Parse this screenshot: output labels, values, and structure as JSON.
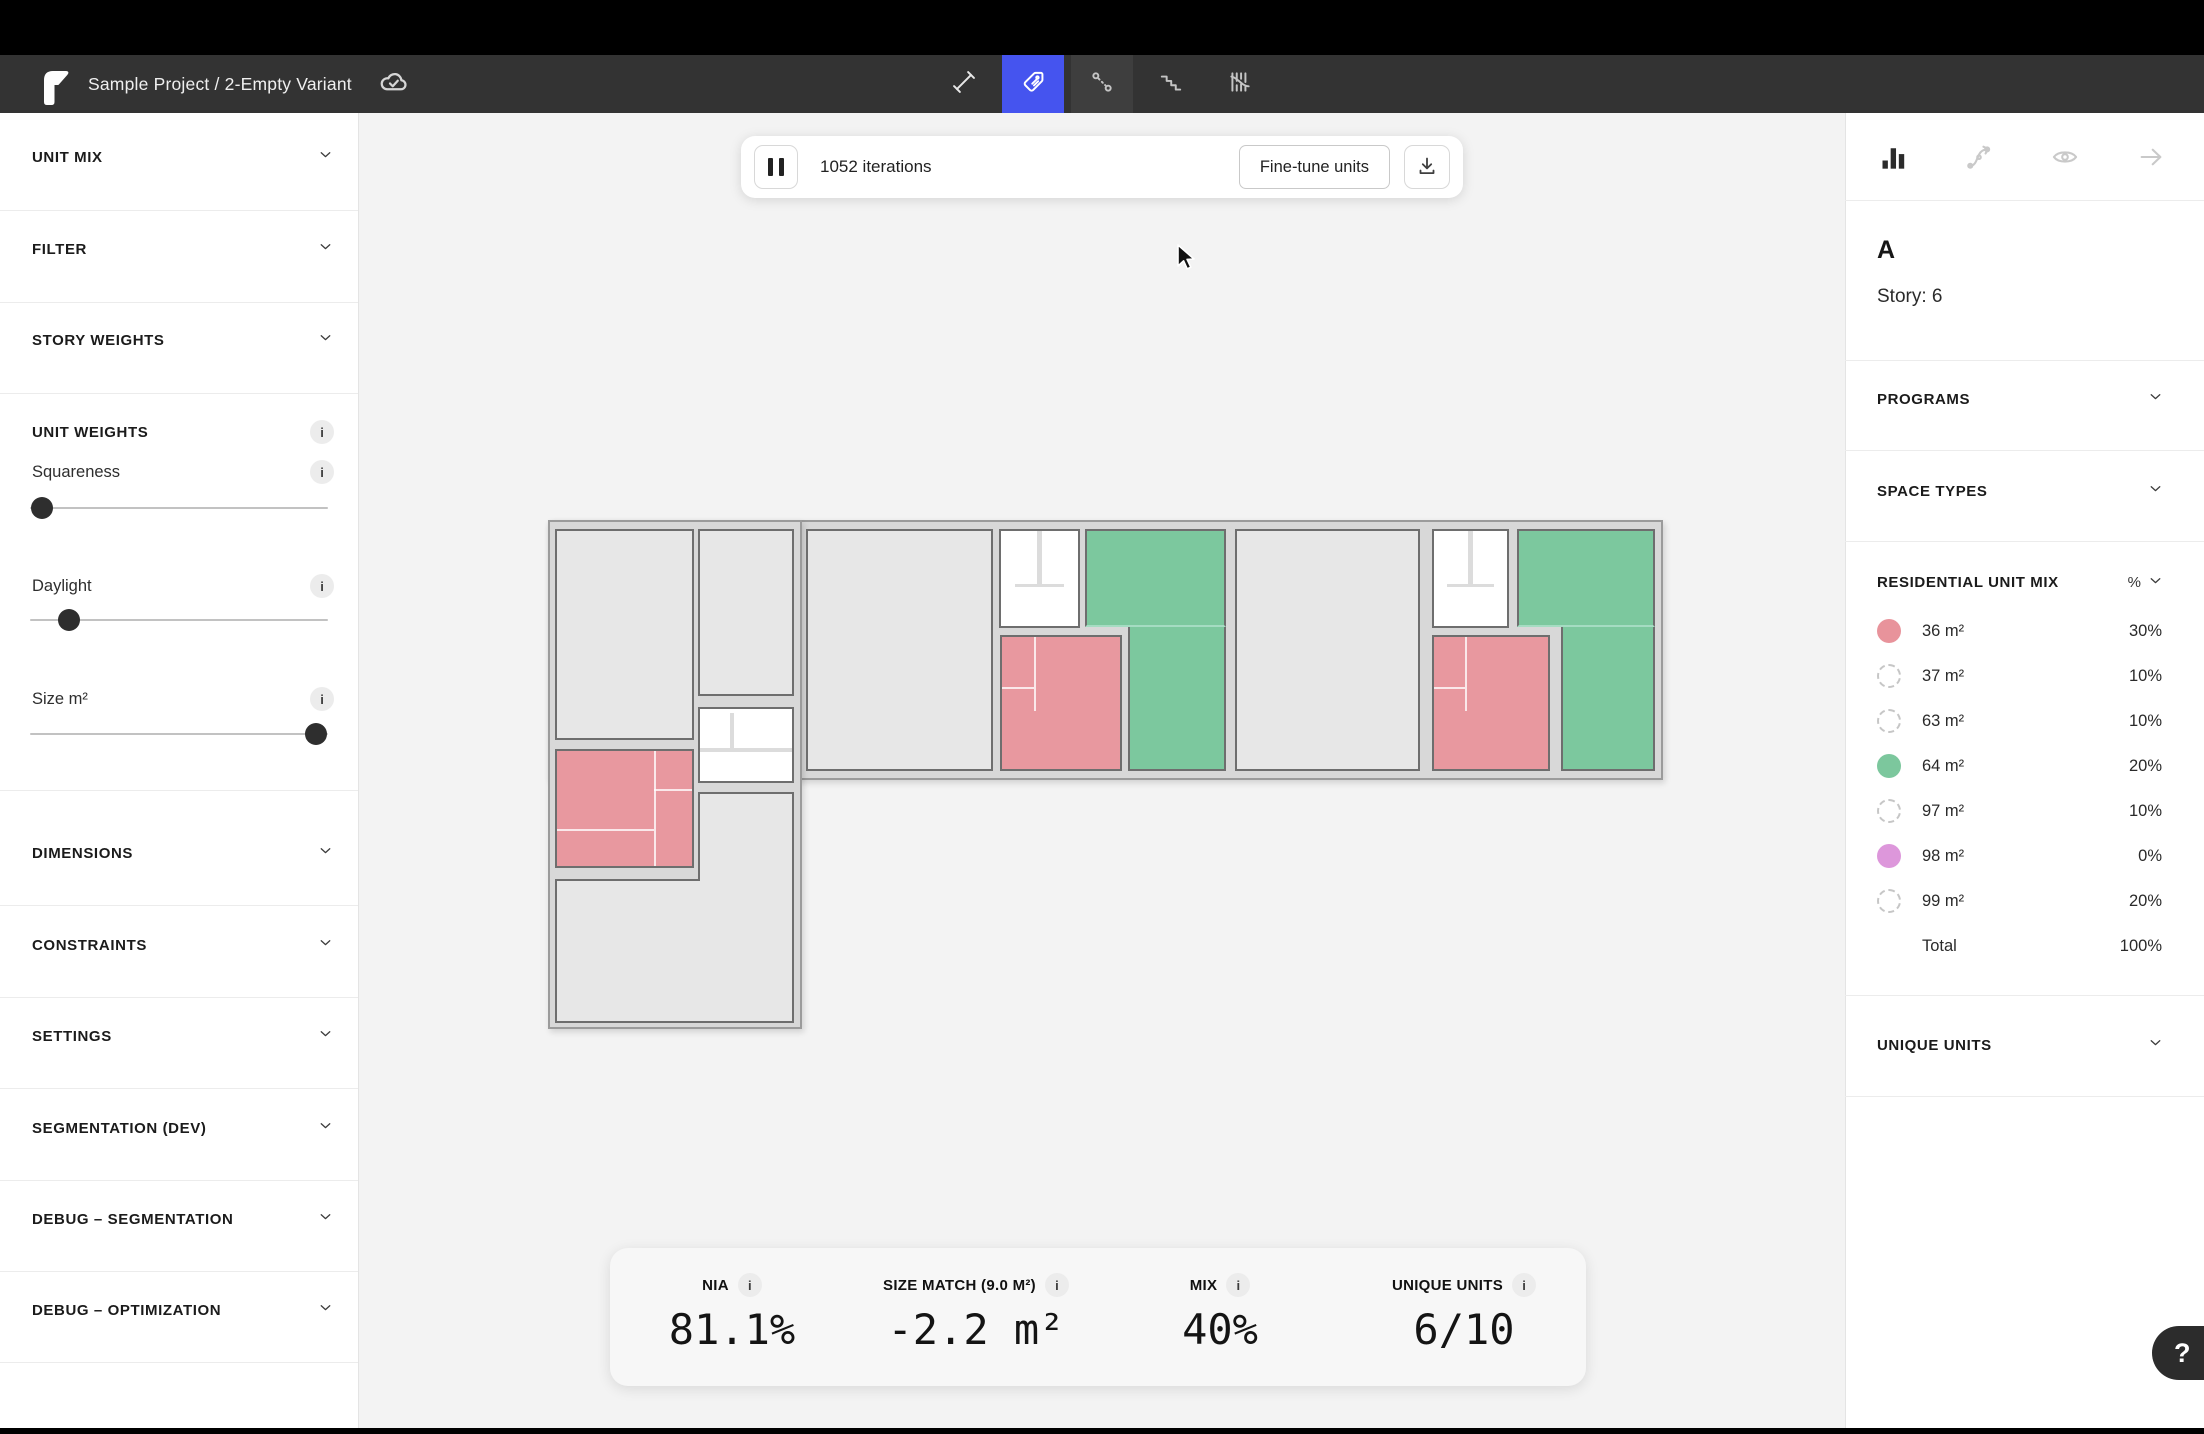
{
  "titlebar": {
    "title": "Sample Project / 2-Empty Variant",
    "logo_icon": "finch-logo",
    "sync_icon": "cloud-check",
    "active_color": "#4554ef",
    "tools": [
      {
        "name": "measure-tool",
        "icon": "measure",
        "active": false,
        "highlight": false
      },
      {
        "name": "tag-tool",
        "icon": "tag",
        "active": true,
        "highlight": false
      },
      {
        "name": "adjacency-tool",
        "icon": "adjacency",
        "active": false,
        "highlight": true
      },
      {
        "name": "stairs-tool",
        "icon": "stairs",
        "active": false,
        "highlight": false
      },
      {
        "name": "hatch-tool",
        "icon": "hatch",
        "active": false,
        "highlight": false
      }
    ]
  },
  "sidebar": {
    "sections_top": [
      {
        "label": "UNIT MIX",
        "y": 157,
        "divider_y": 210
      },
      {
        "label": "FILTER",
        "y": 249,
        "divider_y": 302
      },
      {
        "label": "STORY WEIGHTS",
        "y": 340,
        "divider_y": 393
      }
    ],
    "unit_weights": {
      "label": "UNIT WEIGHTS",
      "y": 432,
      "divider_y": 790,
      "sliders": [
        {
          "label": "Squareness",
          "label_y": 472,
          "slider_y": 508,
          "value_pct": 4
        },
        {
          "label": "Daylight",
          "label_y": 586,
          "slider_y": 620,
          "value_pct": 13
        },
        {
          "label": "Size m²",
          "label_y": 699,
          "slider_y": 734,
          "value_pct": 96
        }
      ]
    },
    "sections_bottom": [
      {
        "label": "DIMENSIONS",
        "y": 853,
        "divider_y": 905
      },
      {
        "label": "CONSTRAINTS",
        "y": 945,
        "divider_y": 997
      },
      {
        "label": "SETTINGS",
        "y": 1036,
        "divider_y": 1088
      },
      {
        "label": "SEGMENTATION (DEV)",
        "y": 1128,
        "divider_y": 1180
      },
      {
        "label": "DEBUG – SEGMENTATION",
        "y": 1219,
        "divider_y": 1271
      },
      {
        "label": "DEBUG – OPTIMIZATION",
        "y": 1310,
        "divider_y": 1362
      }
    ]
  },
  "canvas": {
    "iterations": "1052 iterations",
    "fine_tune_label": "Fine-tune units",
    "stats": [
      {
        "label": "NIA",
        "value": "81.1%"
      },
      {
        "label": "SIZE MATCH (9.0 M²)",
        "value": "-2.2 m²"
      },
      {
        "label": "MIX",
        "value": "40%"
      },
      {
        "label": "UNIQUE UNITS",
        "value": "6/10"
      }
    ]
  },
  "panel": {
    "icons": [
      {
        "name": "chart-icon",
        "active": true
      },
      {
        "name": "flow-icon",
        "active": false
      },
      {
        "name": "eye-icon",
        "active": false
      },
      {
        "name": "arrow-right-icon",
        "active": false
      }
    ],
    "variant": "A",
    "story": "Story: 6",
    "sections": [
      {
        "label": "PROGRAMS",
        "y": 399
      },
      {
        "label": "SPACE TYPES",
        "y": 491
      }
    ],
    "dividers": [
      200,
      360,
      450,
      541,
      995,
      1096
    ],
    "unit_mix": {
      "title": "RESIDENTIAL UNIT MIX",
      "title_y": 582,
      "unit_header": "%",
      "rows_start_y": 631,
      "rows_step": 45,
      "rows": [
        {
          "size": "36 m²",
          "pct": "30%",
          "swatch": "#e8939b"
        },
        {
          "size": "37 m²",
          "pct": "10%",
          "swatch": null
        },
        {
          "size": "63 m²",
          "pct": "10%",
          "swatch": null
        },
        {
          "size": "64 m²",
          "pct": "20%",
          "swatch": "#7cc79d"
        },
        {
          "size": "97 m²",
          "pct": "10%",
          "swatch": null
        },
        {
          "size": "98 m²",
          "pct": "0%",
          "swatch": "#dd97db"
        },
        {
          "size": "99 m²",
          "pct": "20%",
          "swatch": null
        }
      ],
      "total_label": "Total",
      "total_pct": "100%",
      "total_y": 946
    },
    "unique_units": {
      "label": "UNIQUE UNITS",
      "y": 1045
    },
    "help_label": "?"
  },
  "floorplan": {
    "origin_x": 548,
    "origin_y": 520,
    "colors": {
      "gray": "#e7e7e7",
      "green": "#7cc89e",
      "pink": "#e8989f",
      "core": "#ffffff",
      "slab": "#d8d8d8",
      "border": "#6e6e6e",
      "seam": "#a5dcc2"
    },
    "slabs": [
      {
        "x": 0,
        "y": 0,
        "w": 1115,
        "h": 260
      },
      {
        "x": 0,
        "y": 0,
        "w": 254,
        "h": 509
      }
    ],
    "rooms": [
      {
        "t": "gray",
        "x": 7,
        "y": 9,
        "w": 139,
        "h": 211
      },
      {
        "t": "gray",
        "x": 150,
        "y": 9,
        "w": 96,
        "h": 167
      },
      {
        "t": "core",
        "x": 150,
        "y": 187,
        "w": 96,
        "h": 76,
        "stair": "left"
      },
      {
        "t": "pink",
        "x": 7,
        "y": 229,
        "w": 139,
        "h": 119,
        "lines": [
          [
            "v",
            0.72,
            0,
            1
          ],
          [
            "h",
            0.68,
            0,
            0.72
          ],
          [
            "h",
            0.33,
            0.72,
            1
          ]
        ]
      },
      {
        "t": "gray",
        "x": 150,
        "y": 272,
        "w": 96,
        "h": 89,
        "noB": true
      },
      {
        "t": "gray",
        "x": 7,
        "y": 359,
        "w": 239,
        "h": 144,
        "noT": true
      },
      {
        "t": "wall",
        "x": 7,
        "y": 359,
        "w": 145,
        "h": 2
      },
      {
        "t": "gray",
        "x": 258,
        "y": 9,
        "w": 187,
        "h": 242
      },
      {
        "t": "core",
        "x": 451,
        "y": 9,
        "w": 81,
        "h": 99,
        "stair": "top"
      },
      {
        "t": "green",
        "x": 537,
        "y": 9,
        "w": 141,
        "h": 98,
        "seamB": true
      },
      {
        "t": "green",
        "x": 580,
        "y": 107,
        "w": 98,
        "h": 144,
        "noT": true
      },
      {
        "t": "pink",
        "x": 452,
        "y": 115,
        "w": 122,
        "h": 136,
        "lines": [
          [
            "v",
            0.27,
            0,
            0.56
          ],
          [
            "h",
            0.38,
            0,
            0.27
          ]
        ]
      },
      {
        "t": "gray",
        "x": 687,
        "y": 9,
        "w": 185,
        "h": 242
      },
      {
        "t": "core",
        "x": 884,
        "y": 9,
        "w": 77,
        "h": 99,
        "stair": "top"
      },
      {
        "t": "green",
        "x": 969,
        "y": 9,
        "w": 138,
        "h": 98,
        "seamB": true
      },
      {
        "t": "green",
        "x": 1013,
        "y": 107,
        "w": 94,
        "h": 144,
        "noT": true
      },
      {
        "t": "pink",
        "x": 884,
        "y": 115,
        "w": 118,
        "h": 136,
        "lines": [
          [
            "v",
            0.27,
            0,
            0.56
          ],
          [
            "h",
            0.38,
            0,
            0.27
          ]
        ]
      }
    ]
  }
}
